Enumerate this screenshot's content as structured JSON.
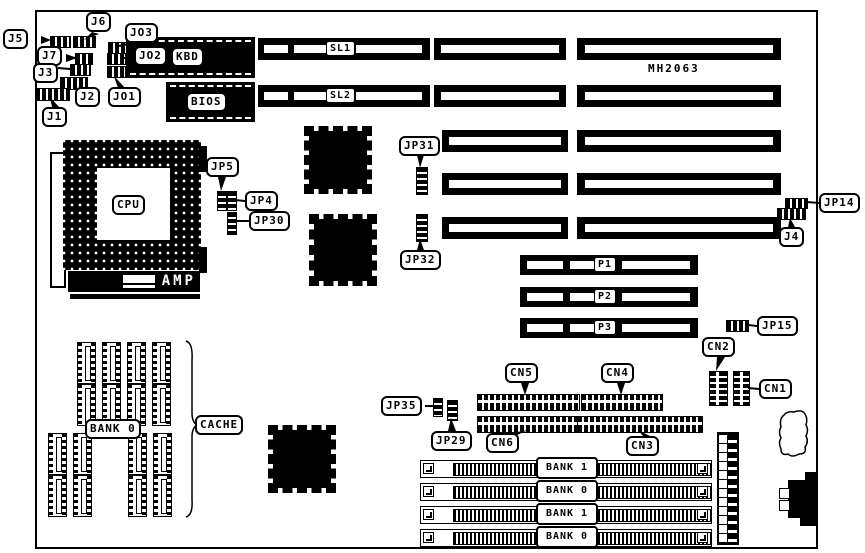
{
  "board": {
    "part_number": "MH2063"
  },
  "labels": {
    "j1": "J1",
    "j2": "J2",
    "j3": "J3",
    "j4": "J4",
    "j5": "J5",
    "j6": "J6",
    "j7": "J7",
    "jo1": "JO1",
    "jo2": "JO2",
    "jo3": "JO3",
    "jp4": "JP4",
    "jp5": "JP5",
    "jp14": "JP14",
    "jp15": "JP15",
    "jp29": "JP29",
    "jp30": "JP30",
    "jp31": "JP31",
    "jp32": "JP32",
    "jp35": "JP35",
    "kbd": "KBD",
    "bios": "BIOS",
    "cpu": "CPU",
    "amp": "AMP",
    "sl1": "SL1",
    "sl2": "SL2",
    "p1": "P1",
    "p2": "P2",
    "p3": "P3",
    "cn1": "CN1",
    "cn2": "CN2",
    "cn3": "CN3",
    "cn4": "CN4",
    "cn5": "CN5",
    "cn6": "CN6",
    "cache": "CACHE",
    "cache_bank": "BANK 0",
    "simm_banks": [
      "BANK 1",
      "BANK 0",
      "BANK 1",
      "BANK 0"
    ]
  }
}
